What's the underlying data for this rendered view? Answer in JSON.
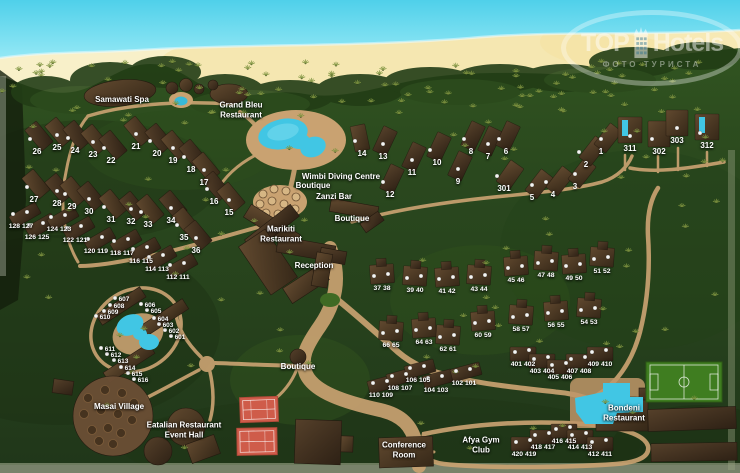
{
  "watermark": {
    "brand_top": "TOP",
    "brand_bottom": "Hotels",
    "subtitle": "ФОТО ТУРИСТА"
  },
  "colors": {
    "ocean": "#4fd0ea",
    "beach": "#f8f0c9",
    "jungle": "#26411c",
    "path_tan": "#c9a271",
    "roof_brown": "#4a3826",
    "pool_cyan": "#41c6e4",
    "tennis_red": "#cf5c4a",
    "pitch_green": "#3f7d20"
  },
  "places": [
    {
      "id": "samawati-spa",
      "label": "Samawati Spa",
      "x": 122,
      "y": 100
    },
    {
      "id": "grand-bleu-restaurant",
      "label": "Grand Bleu\nRestaurant",
      "x": 241,
      "y": 110
    },
    {
      "id": "wimbi-diving-centre",
      "label": "Wimbi Diving Centre",
      "x": 341,
      "y": 177
    },
    {
      "id": "wimbi-boutique",
      "label": "Boutique",
      "x": 313,
      "y": 186
    },
    {
      "id": "zanzi-bar",
      "label": "Zanzi Bar",
      "x": 334,
      "y": 197
    },
    {
      "id": "boutique-central",
      "label": "Boutique",
      "x": 352,
      "y": 219
    },
    {
      "id": "marikiti-restaurant",
      "label": "Marikiti\nRestaurant",
      "x": 281,
      "y": 234
    },
    {
      "id": "reception",
      "label": "Reception",
      "x": 314,
      "y": 266
    },
    {
      "id": "boutique-south",
      "label": "Boutique",
      "x": 298,
      "y": 367
    },
    {
      "id": "masai-village",
      "label": "Masai Village",
      "x": 119,
      "y": 407
    },
    {
      "id": "eatalian-restaurant-event-hall",
      "label": "Eatalian Restaurant\nEvent Hall",
      "x": 184,
      "y": 430
    },
    {
      "id": "conference-room",
      "label": "Conference\nRoom",
      "x": 404,
      "y": 450
    },
    {
      "id": "afya-gym-club",
      "label": "Afya Gym\nClub",
      "x": 481,
      "y": 445
    },
    {
      "id": "bondeni-restaurant",
      "label": "Bondeni\nRestaurant",
      "x": 624,
      "y": 413
    }
  ],
  "units": [
    {
      "n": "26",
      "x": 37,
      "y": 152
    },
    {
      "n": "25",
      "x": 57,
      "y": 148
    },
    {
      "n": "24",
      "x": 75,
      "y": 151
    },
    {
      "n": "23",
      "x": 93,
      "y": 155
    },
    {
      "n": "22",
      "x": 111,
      "y": 161
    },
    {
      "n": "21",
      "x": 136,
      "y": 147
    },
    {
      "n": "20",
      "x": 157,
      "y": 154
    },
    {
      "n": "19",
      "x": 173,
      "y": 161
    },
    {
      "n": "18",
      "x": 191,
      "y": 170
    },
    {
      "n": "17",
      "x": 204,
      "y": 183
    },
    {
      "n": "16",
      "x": 214,
      "y": 202
    },
    {
      "n": "15",
      "x": 229,
      "y": 213
    },
    {
      "n": "27",
      "x": 34,
      "y": 200
    },
    {
      "n": "28",
      "x": 57,
      "y": 204
    },
    {
      "n": "29",
      "x": 72,
      "y": 207
    },
    {
      "n": "30",
      "x": 89,
      "y": 212
    },
    {
      "n": "31",
      "x": 111,
      "y": 220
    },
    {
      "n": "32",
      "x": 131,
      "y": 222
    },
    {
      "n": "33",
      "x": 148,
      "y": 225
    },
    {
      "n": "34",
      "x": 171,
      "y": 221
    },
    {
      "n": "35",
      "x": 184,
      "y": 238
    },
    {
      "n": "36",
      "x": 196,
      "y": 251
    },
    {
      "n": "14",
      "x": 362,
      "y": 154
    },
    {
      "n": "13",
      "x": 383,
      "y": 157
    },
    {
      "n": "12",
      "x": 390,
      "y": 195
    },
    {
      "n": "11",
      "x": 412,
      "y": 173
    },
    {
      "n": "10",
      "x": 437,
      "y": 163
    },
    {
      "n": "9",
      "x": 458,
      "y": 182
    },
    {
      "n": "8",
      "x": 471,
      "y": 152
    },
    {
      "n": "7",
      "x": 488,
      "y": 157
    },
    {
      "n": "6",
      "x": 506,
      "y": 152
    },
    {
      "n": "5",
      "x": 532,
      "y": 198
    },
    {
      "n": "4",
      "x": 553,
      "y": 195
    },
    {
      "n": "3",
      "x": 575,
      "y": 187
    },
    {
      "n": "2",
      "x": 586,
      "y": 165
    },
    {
      "n": "1",
      "x": 601,
      "y": 152
    },
    {
      "n": "301",
      "x": 504,
      "y": 189
    },
    {
      "n": "311",
      "x": 630,
      "y": 149
    },
    {
      "n": "302",
      "x": 659,
      "y": 152
    },
    {
      "n": "303",
      "x": 677,
      "y": 141
    },
    {
      "n": "312",
      "x": 707,
      "y": 146
    },
    {
      "n": "37 38",
      "x": 382,
      "y": 289
    },
    {
      "n": "39 40",
      "x": 415,
      "y": 291
    },
    {
      "n": "41 42",
      "x": 447,
      "y": 292
    },
    {
      "n": "43 44",
      "x": 479,
      "y": 290
    },
    {
      "n": "45 46",
      "x": 516,
      "y": 281
    },
    {
      "n": "47 48",
      "x": 546,
      "y": 276
    },
    {
      "n": "49 50",
      "x": 574,
      "y": 279
    },
    {
      "n": "51 52",
      "x": 602,
      "y": 272
    },
    {
      "n": "66 65",
      "x": 391,
      "y": 346
    },
    {
      "n": "64 63",
      "x": 424,
      "y": 343
    },
    {
      "n": "62 61",
      "x": 448,
      "y": 350
    },
    {
      "n": "60 59",
      "x": 483,
      "y": 336
    },
    {
      "n": "58 57",
      "x": 521,
      "y": 330
    },
    {
      "n": "56 55",
      "x": 556,
      "y": 326
    },
    {
      "n": "54 53",
      "x": 589,
      "y": 323
    },
    {
      "n": "128 127",
      "x": 21,
      "y": 227
    },
    {
      "n": "126 125",
      "x": 37,
      "y": 238
    },
    {
      "n": "124 123",
      "x": 59,
      "y": 230
    },
    {
      "n": "122 121",
      "x": 75,
      "y": 241
    },
    {
      "n": "120 119",
      "x": 96,
      "y": 252
    },
    {
      "n": "118 117",
      "x": 122,
      "y": 254
    },
    {
      "n": "116 115",
      "x": 141,
      "y": 262
    },
    {
      "n": "114 113",
      "x": 157,
      "y": 270
    },
    {
      "n": "112 111",
      "x": 178,
      "y": 278
    },
    {
      "n": "110 109",
      "x": 381,
      "y": 396
    },
    {
      "n": "108 107",
      "x": 400,
      "y": 389
    },
    {
      "n": "106 105",
      "x": 418,
      "y": 381
    },
    {
      "n": "104 103",
      "x": 436,
      "y": 391
    },
    {
      "n": "102 101",
      "x": 464,
      "y": 384
    },
    {
      "n": "401 402",
      "x": 523,
      "y": 365
    },
    {
      "n": "403 404",
      "x": 542,
      "y": 372
    },
    {
      "n": "405 406",
      "x": 560,
      "y": 378
    },
    {
      "n": "407 408",
      "x": 579,
      "y": 372
    },
    {
      "n": "409 410",
      "x": 600,
      "y": 365
    },
    {
      "n": "420 419",
      "x": 524,
      "y": 455
    },
    {
      "n": "418 417",
      "x": 543,
      "y": 448
    },
    {
      "n": "416 415",
      "x": 564,
      "y": 442
    },
    {
      "n": "414 413",
      "x": 580,
      "y": 448
    },
    {
      "n": "412 411",
      "x": 600,
      "y": 455
    },
    {
      "n": "607",
      "x": 124,
      "y": 300
    },
    {
      "n": "608",
      "x": 119,
      "y": 307
    },
    {
      "n": "609",
      "x": 113,
      "y": 313
    },
    {
      "n": "610",
      "x": 105,
      "y": 318
    },
    {
      "n": "606",
      "x": 150,
      "y": 306
    },
    {
      "n": "605",
      "x": 156,
      "y": 312
    },
    {
      "n": "604",
      "x": 163,
      "y": 320
    },
    {
      "n": "603",
      "x": 168,
      "y": 326
    },
    {
      "n": "602",
      "x": 174,
      "y": 332
    },
    {
      "n": "601",
      "x": 180,
      "y": 338
    },
    {
      "n": "611",
      "x": 110,
      "y": 350
    },
    {
      "n": "612",
      "x": 116,
      "y": 356
    },
    {
      "n": "613",
      "x": 123,
      "y": 362
    },
    {
      "n": "614",
      "x": 130,
      "y": 369
    },
    {
      "n": "615",
      "x": 137,
      "y": 375
    },
    {
      "n": "616",
      "x": 143,
      "y": 381
    }
  ]
}
